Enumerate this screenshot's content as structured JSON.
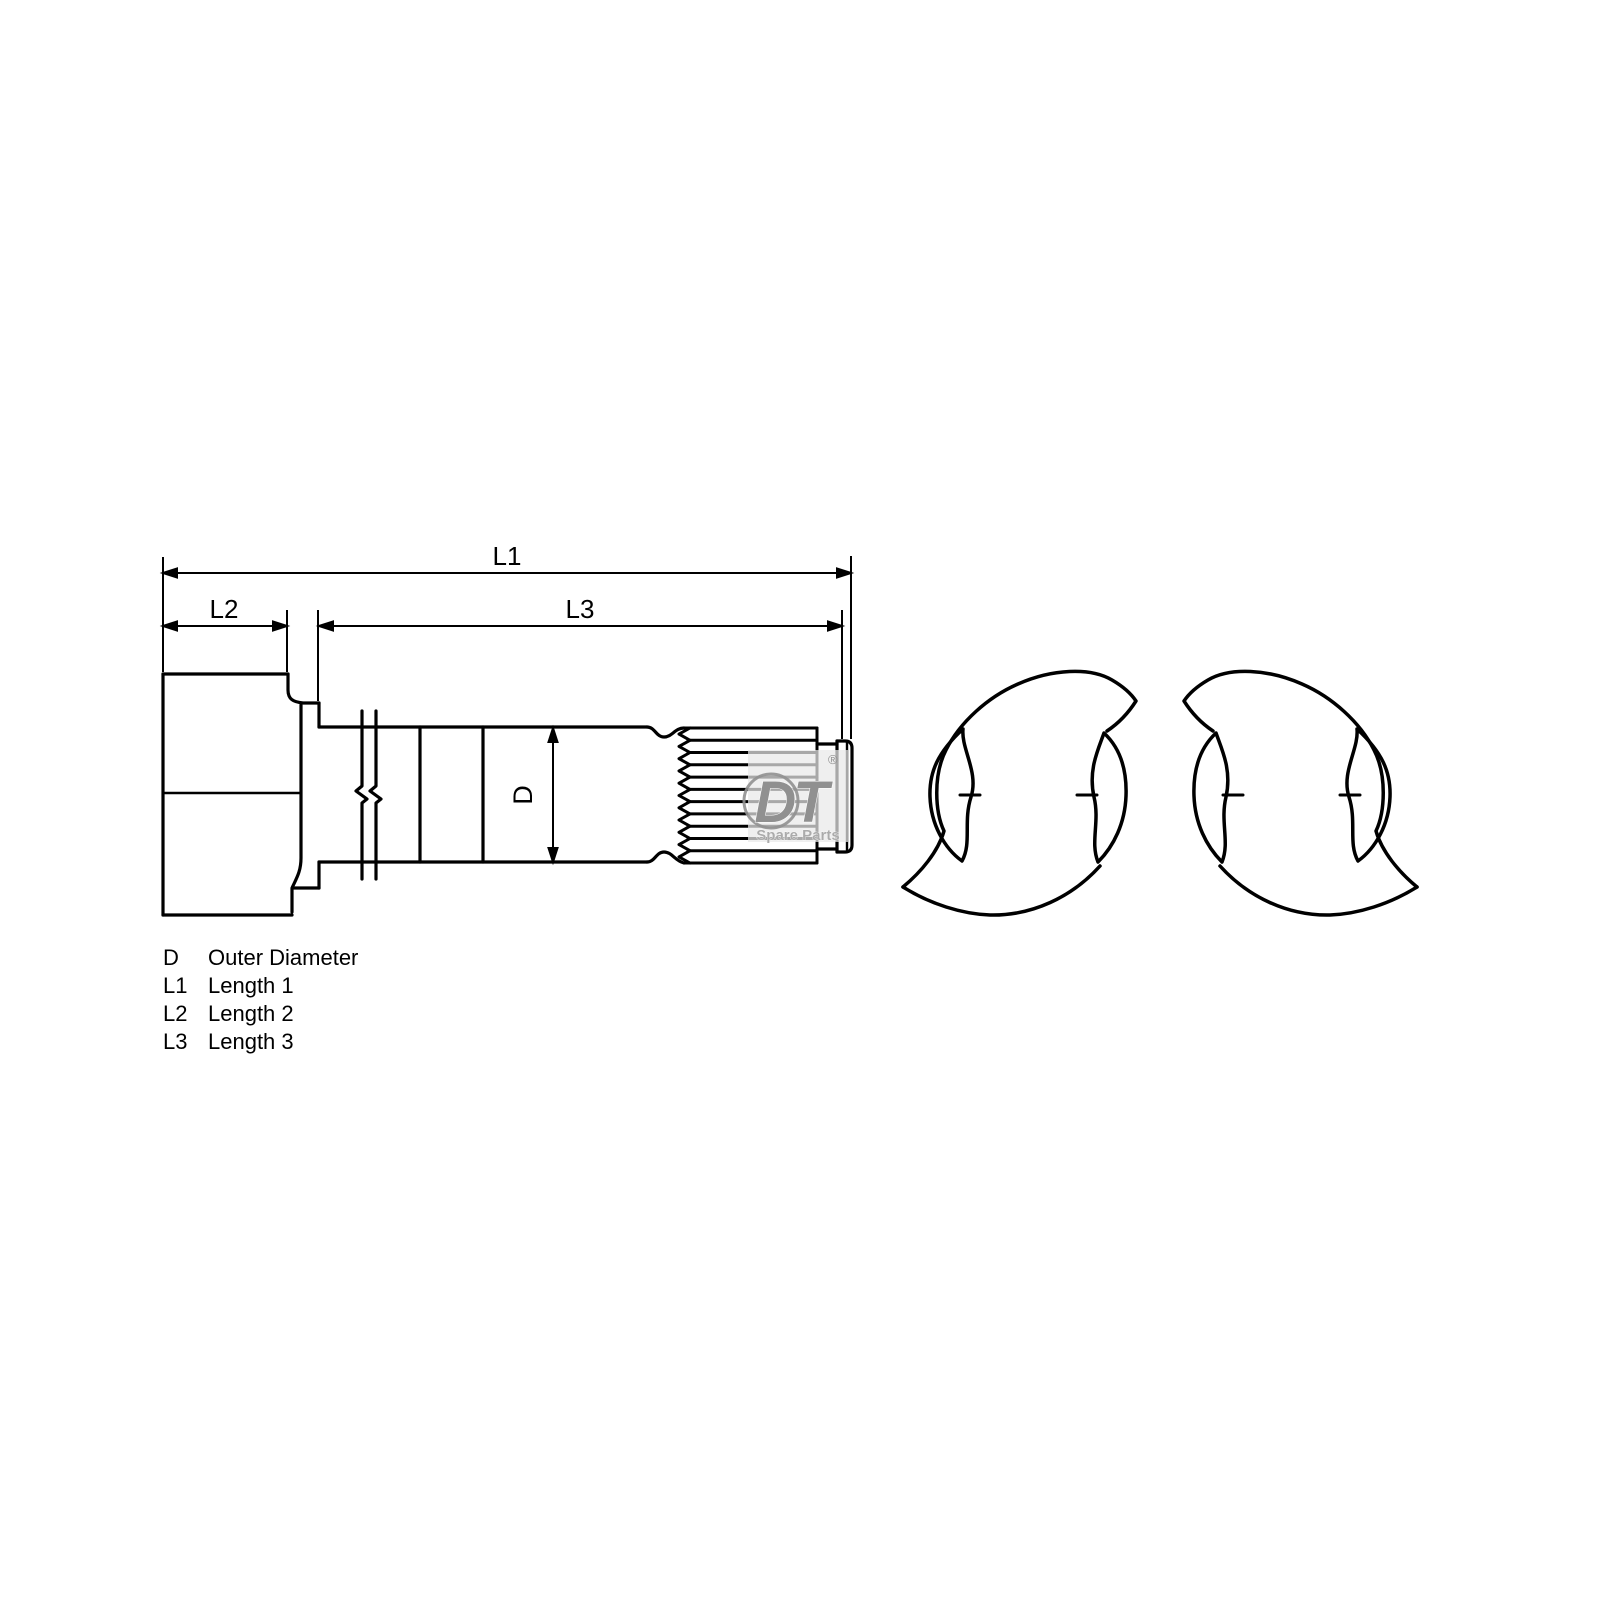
{
  "dimension_labels": {
    "l1": "L1",
    "l2": "L2",
    "l3": "L3",
    "d": "D"
  },
  "legend": {
    "rows": [
      {
        "symbol": "D",
        "description": "Outer Diameter"
      },
      {
        "symbol": "L1",
        "description": "Length 1"
      },
      {
        "symbol": "L2",
        "description": "Length 2"
      },
      {
        "symbol": "L3",
        "description": "Length 3"
      }
    ]
  },
  "watermark": {
    "brand": "DT",
    "registered_mark": "®",
    "tagline": "Spare Parts",
    "color": "#909090"
  },
  "colors": {
    "background": "#ffffff",
    "line": "#000000"
  }
}
